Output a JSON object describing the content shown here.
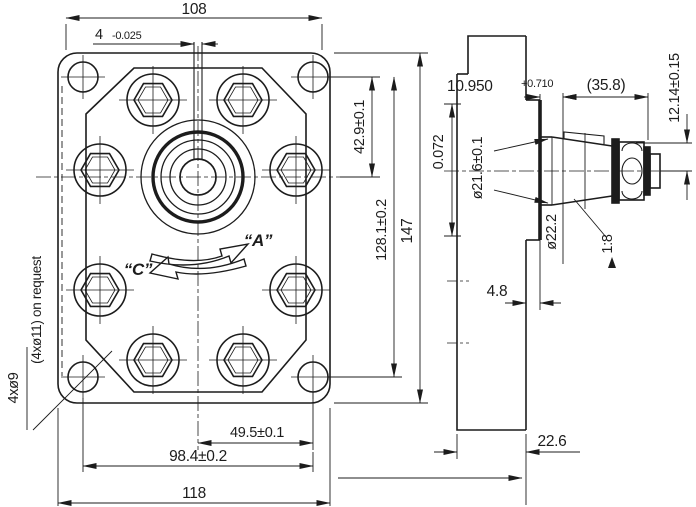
{
  "drawing": {
    "type": "technical-drawing",
    "subject": "gear pump flange and tapered shaft, two orthographic views"
  },
  "colors": {
    "line": "#1c1c1c",
    "background": "#ffffff"
  },
  "front": {
    "dim_108": "108",
    "key_width": "4",
    "key_width_tol": "-0.025",
    "dim_42_9": "42.9±0.1",
    "dim_128_1": "128.1±0.2",
    "dim_147": "147",
    "dim_49_5": "49.5±0.1",
    "dim_98_4": "98.4±0.2",
    "dim_118": "118",
    "holes_note_line1": "4xø9",
    "holes_note_line2": "(4xø11) on request",
    "rotation_c": "“C”",
    "rotation_a": "“A”"
  },
  "side": {
    "dim_left_tol": "0.072",
    "dim_10_950": "10.950",
    "dim_10_950_tol": "+0.710",
    "dim_35_8": "(35.8)",
    "dim_12_14": "12.14±0.15",
    "dia_21_6": "ø21.6±0.1",
    "dia_22_2": "ø22.2",
    "taper_ratio": "1:8",
    "dim_4_8": "4.8",
    "dim_22_6": "22.6"
  }
}
